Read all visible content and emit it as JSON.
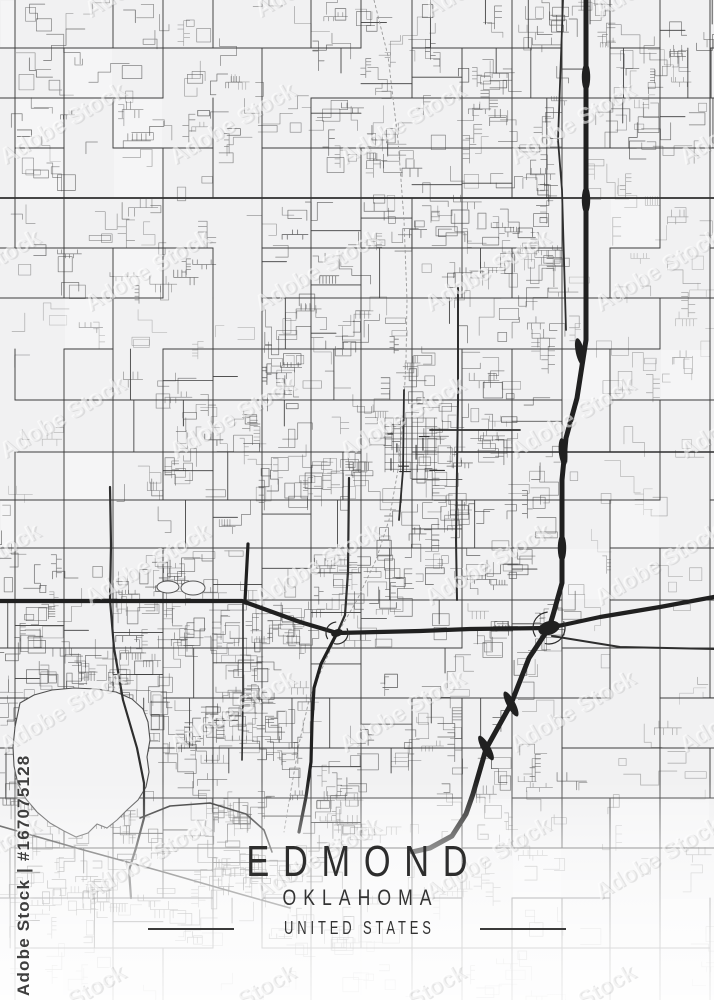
{
  "title": {
    "city": "EDMOND",
    "region": "OKLAHOMA",
    "country": "UNITED STATES"
  },
  "watermark": {
    "tile_text": "Adobe Stock",
    "corner_text": "Adobe Stock | #167075128"
  },
  "map": {
    "width": 714,
    "height": 1000,
    "seed": 1337,
    "colors": {
      "background": "#f1f1f2",
      "minor_road": "#4a4a4a",
      "rural_road": "#8f8f8f",
      "grid_road": "#3d3d3d",
      "connector_road": "#3c3c3c",
      "medium_road": "#2e2e2e",
      "major_road": "#202020",
      "water_fill": "#f3f3f4",
      "water_outline": "#4f4f4f",
      "railroad": "#999999",
      "fade": "#ffffff"
    },
    "grid_x": [
      15,
      64,
      113,
      163,
      213,
      262,
      311,
      361,
      412,
      462,
      512,
      562,
      610,
      660,
      710
    ],
    "grid_y": [
      48,
      98,
      148,
      198,
      248,
      298,
      349,
      400,
      452,
      500,
      548,
      600,
      648,
      698,
      748,
      798,
      848,
      898,
      948
    ],
    "density_base": 0.2,
    "density_regions": [
      {
        "x": 0,
        "y": 0,
        "w": 330,
        "h": 300,
        "d": 0.3
      },
      {
        "x": 330,
        "y": 0,
        "w": 230,
        "h": 270,
        "d": 0.5
      },
      {
        "x": 560,
        "y": 0,
        "w": 154,
        "h": 160,
        "d": 0.5
      },
      {
        "x": 240,
        "y": 260,
        "w": 330,
        "h": 320,
        "d": 0.7
      },
      {
        "x": 110,
        "y": 370,
        "w": 150,
        "h": 200,
        "d": 0.62
      },
      {
        "x": 0,
        "y": 300,
        "w": 110,
        "h": 250,
        "d": 0.14
      },
      {
        "x": 0,
        "y": 540,
        "w": 340,
        "h": 340,
        "d": 0.8
      },
      {
        "x": 340,
        "y": 560,
        "w": 200,
        "h": 260,
        "d": 0.5
      },
      {
        "x": 420,
        "y": 640,
        "w": 160,
        "h": 180,
        "d": 0.4
      },
      {
        "x": 0,
        "y": 860,
        "w": 340,
        "h": 110,
        "d": 0.55
      },
      {
        "x": 340,
        "y": 840,
        "w": 280,
        "h": 160,
        "d": 0.28
      },
      {
        "x": 600,
        "y": 160,
        "w": 114,
        "h": 480,
        "d": 0.17
      },
      {
        "x": 560,
        "y": 650,
        "w": 154,
        "h": 260,
        "d": 0.2
      }
    ],
    "downtown": {
      "x": 385,
      "y": 418,
      "w": 52,
      "h": 54
    },
    "major_roads": [
      {
        "name": "second-street-west",
        "w": 4.2,
        "pts": [
          [
            0,
            601
          ],
          [
            242,
            601
          ],
          [
            300,
            622
          ],
          [
            337,
            633
          ]
        ]
      },
      {
        "name": "second-street-mid",
        "w": 4.2,
        "pts": [
          [
            337,
            633
          ],
          [
            420,
            631
          ],
          [
            470,
            629
          ],
          [
            549,
            628
          ]
        ]
      },
      {
        "name": "highway-northeast",
        "w": 4.2,
        "pts": [
          [
            549,
            628
          ],
          [
            600,
            617
          ],
          [
            660,
            607
          ],
          [
            714,
            597
          ]
        ]
      },
      {
        "name": "i35-north",
        "w": 5,
        "pts": [
          [
            586,
            0
          ],
          [
            586,
            340
          ],
          [
            577,
            398
          ],
          [
            566,
            438
          ],
          [
            562,
            480
          ],
          [
            562,
            583
          ],
          [
            553,
            615
          ],
          [
            549,
            628
          ]
        ]
      },
      {
        "name": "i35-south",
        "w": 5,
        "pts": [
          [
            549,
            628
          ],
          [
            529,
            658
          ],
          [
            511,
            704
          ],
          [
            486,
            749
          ],
          [
            473,
            794
          ],
          [
            466,
            814
          ],
          [
            452,
            836
          ],
          [
            430,
            848
          ],
          [
            412,
            852
          ]
        ]
      },
      {
        "name": "broadway-south",
        "w": 3.2,
        "pts": [
          [
            337,
            633
          ],
          [
            321,
            664
          ],
          [
            314,
            688
          ],
          [
            312,
            722
          ],
          [
            311,
            762
          ],
          [
            306,
            797
          ],
          [
            299,
            832
          ]
        ]
      },
      {
        "name": "kelly-north",
        "w": 3.2,
        "pts": [
          [
            248,
            544
          ],
          [
            245,
            601
          ]
        ]
      }
    ],
    "medium_roads": [
      {
        "name": "covell-road",
        "w": 1.8,
        "pts": [
          [
            0,
            198
          ],
          [
            714,
            198
          ]
        ]
      },
      {
        "name": "danforth-east",
        "w": 1.5,
        "pts": [
          [
            455,
            452
          ],
          [
            714,
            452
          ]
        ]
      },
      {
        "name": "lakeside-road",
        "w": 2.2,
        "pts": [
          [
            110,
            487
          ],
          [
            111,
            545
          ],
          [
            110,
            600
          ],
          [
            114,
            648
          ],
          [
            123,
            700
          ],
          [
            137,
            748
          ],
          [
            144,
            783
          ],
          [
            144,
            818
          ],
          [
            136,
            848
          ],
          [
            129,
            870
          ],
          [
            131,
            898
          ]
        ]
      },
      {
        "name": "kelly-south",
        "w": 1.6,
        "pts": [
          [
            243,
            604
          ],
          [
            243,
            700
          ],
          [
            242,
            760
          ]
        ]
      },
      {
        "name": "boulevard",
        "w": 2.2,
        "pts": [
          [
            349,
            478
          ],
          [
            348,
            572
          ],
          [
            345,
            615
          ],
          [
            338,
            631
          ]
        ]
      },
      {
        "name": "downtown-broadway",
        "w": 2,
        "pts": [
          [
            458,
            288
          ],
          [
            458,
            400
          ],
          [
            457,
            470
          ],
          [
            456,
            540
          ],
          [
            457,
            600
          ]
        ]
      },
      {
        "name": "downtown-rail-street",
        "w": 1.8,
        "pts": [
          [
            404,
            390
          ],
          [
            403,
            470
          ],
          [
            399,
            520
          ]
        ]
      },
      {
        "name": "downtown-main",
        "w": 1.8,
        "pts": [
          [
            430,
            430
          ],
          [
            520,
            430
          ]
        ]
      },
      {
        "name": "frontage-road",
        "w": 1.8,
        "pts": [
          [
            563,
            0
          ],
          [
            558,
            140
          ],
          [
            562,
            190
          ],
          [
            564,
            260
          ],
          [
            566,
            330
          ]
        ]
      },
      {
        "name": "second-street-business",
        "w": 2,
        "pts": [
          [
            552,
            636
          ],
          [
            620,
            647
          ],
          [
            714,
            649
          ]
        ]
      },
      {
        "name": "lake-arc-road",
        "w": 1.6,
        "pts": [
          [
            140,
            818
          ],
          [
            170,
            806
          ],
          [
            210,
            803
          ],
          [
            246,
            814
          ],
          [
            264,
            830
          ],
          [
            272,
            852
          ]
        ]
      },
      {
        "name": "southwest-diagonal",
        "w": 1.6,
        "pts": [
          [
            0,
            826
          ],
          [
            80,
            849
          ],
          [
            160,
            871
          ],
          [
            240,
            894
          ],
          [
            290,
            908
          ]
        ]
      }
    ],
    "railroads": [
      {
        "pts": [
          [
            374,
            0
          ],
          [
            388,
            56
          ],
          [
            398,
            140
          ],
          [
            404,
            220
          ],
          [
            407,
            300
          ],
          [
            406,
            360
          ],
          [
            403,
            420
          ],
          [
            398,
            470
          ],
          [
            389,
            520
          ],
          [
            376,
            560
          ],
          [
            357,
            600
          ],
          [
            339,
            631
          ]
        ]
      },
      {
        "pts": [
          [
            339,
            631
          ],
          [
            324,
            664
          ],
          [
            309,
            700
          ],
          [
            299,
            744
          ],
          [
            291,
            790
          ],
          [
            284,
            832
          ]
        ]
      }
    ],
    "lake": {
      "pts": [
        [
          20,
          703
        ],
        [
          34,
          695
        ],
        [
          52,
          690
        ],
        [
          74,
          688
        ],
        [
          96,
          689
        ],
        [
          116,
          692
        ],
        [
          132,
          699
        ],
        [
          143,
          709
        ],
        [
          148,
          722
        ],
        [
          150,
          740
        ],
        [
          147,
          757
        ],
        [
          149,
          772
        ],
        [
          146,
          787
        ],
        [
          138,
          800
        ],
        [
          127,
          810
        ],
        [
          117,
          820
        ],
        [
          107,
          828
        ],
        [
          97,
          824
        ],
        [
          88,
          833
        ],
        [
          76,
          837
        ],
        [
          64,
          831
        ],
        [
          50,
          823
        ],
        [
          37,
          812
        ],
        [
          26,
          799
        ],
        [
          18,
          784
        ],
        [
          14,
          766
        ],
        [
          13,
          747
        ],
        [
          15,
          727
        ]
      ]
    },
    "ponds": [
      {
        "cx": 168,
        "cy": 587,
        "rx": 11,
        "ry": 6
      },
      {
        "cx": 193,
        "cy": 588,
        "rx": 12,
        "ry": 7
      }
    ],
    "highway_bulges": [
      {
        "x": 586,
        "y": 77,
        "a": 90
      },
      {
        "x": 586,
        "y": 200,
        "a": 90
      },
      {
        "x": 580,
        "y": 352,
        "a": 78
      },
      {
        "x": 563,
        "y": 452,
        "a": 84
      },
      {
        "x": 562,
        "y": 548,
        "a": 90
      },
      {
        "x": 511,
        "y": 704,
        "a": 62
      },
      {
        "x": 486,
        "y": 748,
        "a": 60
      }
    ],
    "interchanges": [
      {
        "x": 549,
        "y": 628,
        "r": 11
      },
      {
        "x": 337,
        "y": 633,
        "r": 6
      }
    ],
    "fade_stops": [
      [
        0.78,
        0
      ],
      [
        0.85,
        0.5
      ],
      [
        0.9,
        0.68
      ],
      [
        0.94,
        0.8
      ],
      [
        1,
        0.9
      ]
    ],
    "watermark_tiles": {
      "font_px": 23,
      "angle_deg": -30,
      "dx": 170,
      "dy": 147,
      "stagger": 85,
      "x0": -80,
      "y0": 18,
      "cols": 6,
      "rows": 8
    }
  }
}
